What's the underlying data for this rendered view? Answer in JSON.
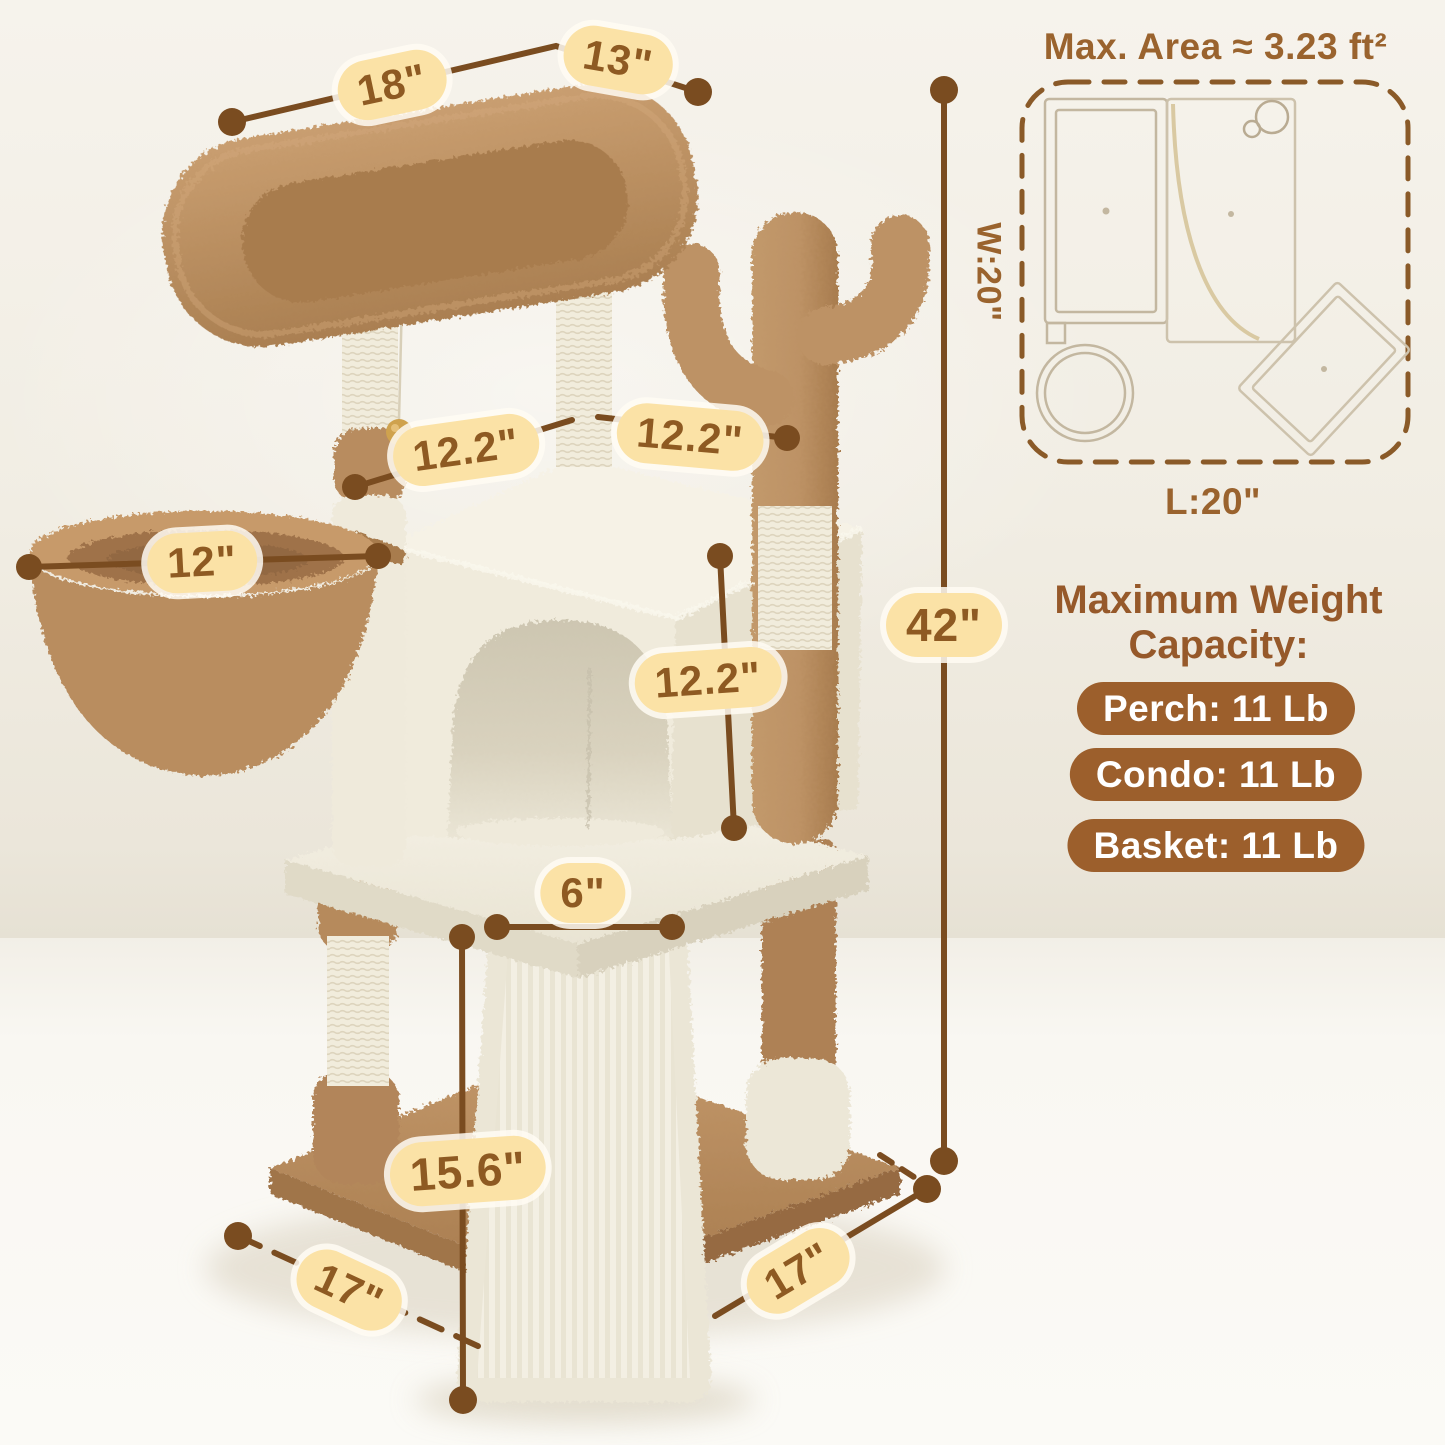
{
  "measurements": {
    "perch_length": "18\"",
    "perch_width": "13\"",
    "condo_roof_left": "12.2\"",
    "condo_roof_right": "12.2\"",
    "basket_diameter": "12\"",
    "condo_height": "12.2\"",
    "ramp_board_width": "6\"",
    "ramp_height": "15.6\"",
    "base_depth": "17\"",
    "base_width": "17\"",
    "total_height": "42\""
  },
  "floor_plan": {
    "title": "Max. Area ≈ 3.23 ft²",
    "width_label": "W:20\"",
    "length_label": "L:20\""
  },
  "weight_capacity": {
    "heading_line1": "Maximum Weight",
    "heading_line2": "Capacity:",
    "badges": [
      "Perch: 11 Lb",
      "Condo: 11 Lb",
      "Basket: 11 Lb"
    ]
  },
  "colors": {
    "accent_brown_text": "#8e5a22",
    "label_pill_fill": "#fbe2a6",
    "badge_fill": "#9c5f2c",
    "dimension_line": "#7a4c20",
    "plush_brown": "#bb8f60",
    "plush_cream": "#f1ecdf"
  }
}
